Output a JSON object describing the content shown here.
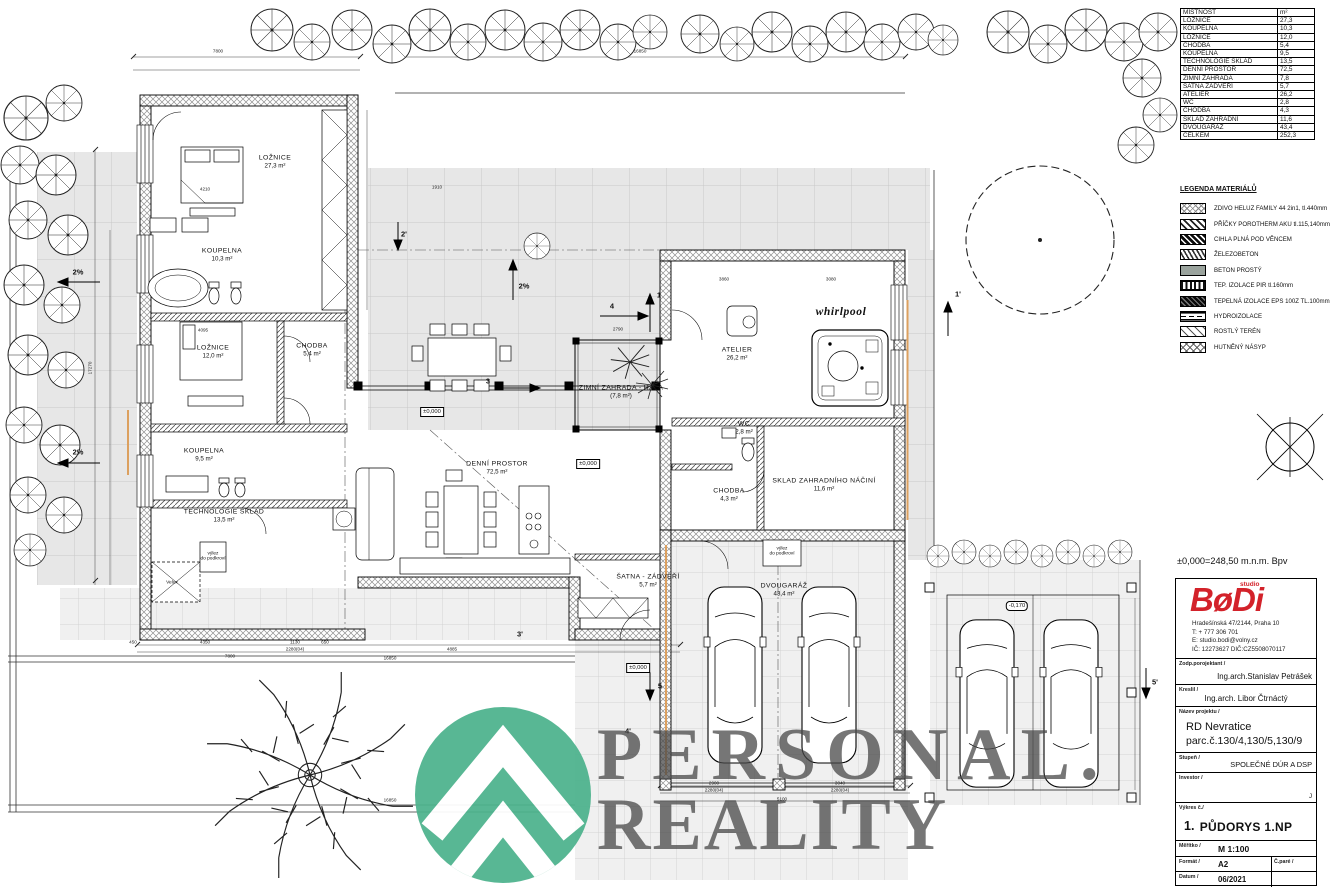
{
  "watermark": {
    "line1": "PERSONAL.",
    "line2": "REALITY",
    "green": "#4cb28c",
    "text_color": "#484848"
  },
  "rooms": [
    {
      "name": "LOŽNICE",
      "area": "27,3 m²"
    },
    {
      "name": "KOUPELNA",
      "area": "10,3 m²"
    },
    {
      "name": "LOŽNICE",
      "area": "12,0 m²"
    },
    {
      "name": "CHODBA",
      "area": "5,4 m²"
    },
    {
      "name": "KOUPELNA",
      "area": "9,5 m²"
    },
    {
      "name": "TECHNOLOGIE SKLAD",
      "area": "13,5 m²"
    },
    {
      "name": "DENNÍ PROSTOR",
      "area": "72,5 m²"
    },
    {
      "name": "ZIMNÍ ZAHRADA - HALA",
      "area": "(7,8 m²)"
    },
    {
      "name": "ŠATNA - ZÁDVEŘÍ",
      "area": "5,7 m²"
    },
    {
      "name": "ATELIER",
      "area": "26,2 m²"
    },
    {
      "name": "WC",
      "area": "2,8 m²"
    },
    {
      "name": "CHODBA",
      "area": "4,3 m²"
    },
    {
      "name": "SKLAD ZAHRADNÍHO NÁČINÍ",
      "area": "11,6 m²"
    },
    {
      "name": "DVOUGARÁŽ",
      "area": "43,4 m²"
    }
  ],
  "labels": {
    "whirlpool": "whirlpool",
    "velux": "Velux",
    "hatch_tech": "výlez\ndo podkroví",
    "hatch_garage": "výlez\ndo podkroví",
    "zero": "±0,000",
    "minus": "-0,170"
  },
  "markers": [
    "2'",
    "1",
    "4",
    "3",
    "1'",
    "5",
    "3'",
    "4'",
    "5'",
    "2%",
    "2%",
    "2%"
  ],
  "dims": [
    "7800",
    "16850",
    "450",
    "4350",
    "1130",
    "650",
    "2280(04)",
    "7800",
    "16850",
    "4885",
    "4210",
    "1910",
    "4095",
    "3860",
    "3080",
    "2790",
    "17270",
    "2900",
    "3040",
    "2280(04)",
    "2280(04)",
    "5100",
    "16850"
  ],
  "rooms_table": {
    "header": {
      "name": "MÍSTNOST",
      "unit": "m²"
    },
    "rows": [
      {
        "label": "LOŽNICE",
        "value": "27,3"
      },
      {
        "label": "KOUPELNA",
        "value": "10,3"
      },
      {
        "label": "LOŽNICE",
        "value": "12,0"
      },
      {
        "label": "CHODBA",
        "value": "5,4"
      },
      {
        "label": "KOUPELNA",
        "value": "9,5"
      },
      {
        "label": "TECHNOLOGIE SKLAD",
        "value": "13,5"
      },
      {
        "label": "DENNÍ PROSTOR",
        "value": "72,5"
      },
      {
        "label": "ZIMNÍ ZAHRADA",
        "value": "7,8"
      },
      {
        "label": "ŠATNA ZÁDVEŘÍ",
        "value": "5,7"
      },
      {
        "label": "ATELIER",
        "value": "26,2"
      },
      {
        "label": "WC",
        "value": "2,8"
      },
      {
        "label": "CHODBA",
        "value": "4,3"
      },
      {
        "label": "SKLAD ZAHRADNÍ",
        "value": "11,6"
      },
      {
        "label": "DVOUGARÁŽ",
        "value": "43,4"
      },
      {
        "label": "CELKEM",
        "value": "252,3"
      }
    ]
  },
  "legend": {
    "title": "LEGENDA MATERIÁLŮ",
    "items": [
      "ZDIVO HELUZ FAMILY 44 2in1, tl.440mm",
      "PŘÍČKY POROTHERM AKU tl.115,140mm",
      "CIHLA PLNÁ POD VĚNCEM",
      "ŽELEZOBETON",
      "BETON PROSTÝ",
      "TEP. IZOLACE PIR  tl.160mm",
      "TEPELNÁ IZOLACE EPS 100Z TL.100mm",
      "HYDROIZOLACE",
      "ROSTLÝ TERÉN",
      "HUTNĚNÝ NÁSYP"
    ]
  },
  "titleblock": {
    "elevation_note": "±0,000=248,50 m.n.m.  Bpv",
    "brand": "BøDi",
    "brand_small": "studio",
    "address": "Hradešínská 47/2144, Praha 10",
    "phone": "T: + 777 306 701",
    "email": "E: studio.bodi@volny.cz",
    "ids": "IČ: 12273627 DIČ:CZ5508070117",
    "resp_label": "Zodp.porojektant /",
    "resp_name": "Ing.arch.Stanislav Petrášek",
    "drew_label": "Kreslil /",
    "drew_name": "Ing.arch. Libor Čtrnáctý",
    "project_label": "Název projektu /",
    "project_name": "RD Nevratice",
    "project_parcel": "parc.č.130/4,130/5,130/9",
    "stage_label": "Stupeň /",
    "stage": "SPOLEČNÉ DÚR A DSP",
    "investor_label": "Investor /",
    "investor_note": "J",
    "drawing_no_label": "Výkres  č./",
    "drawing_no": "1.",
    "drawing_name": "PŮDORYS 1.NP",
    "scale_label": "Měřítko /",
    "scale": "M 1:100",
    "format_label": "Formát /",
    "format": "A2",
    "pare_label": "Č.paré /",
    "date_label": "Datum /",
    "date": "06/2021"
  }
}
